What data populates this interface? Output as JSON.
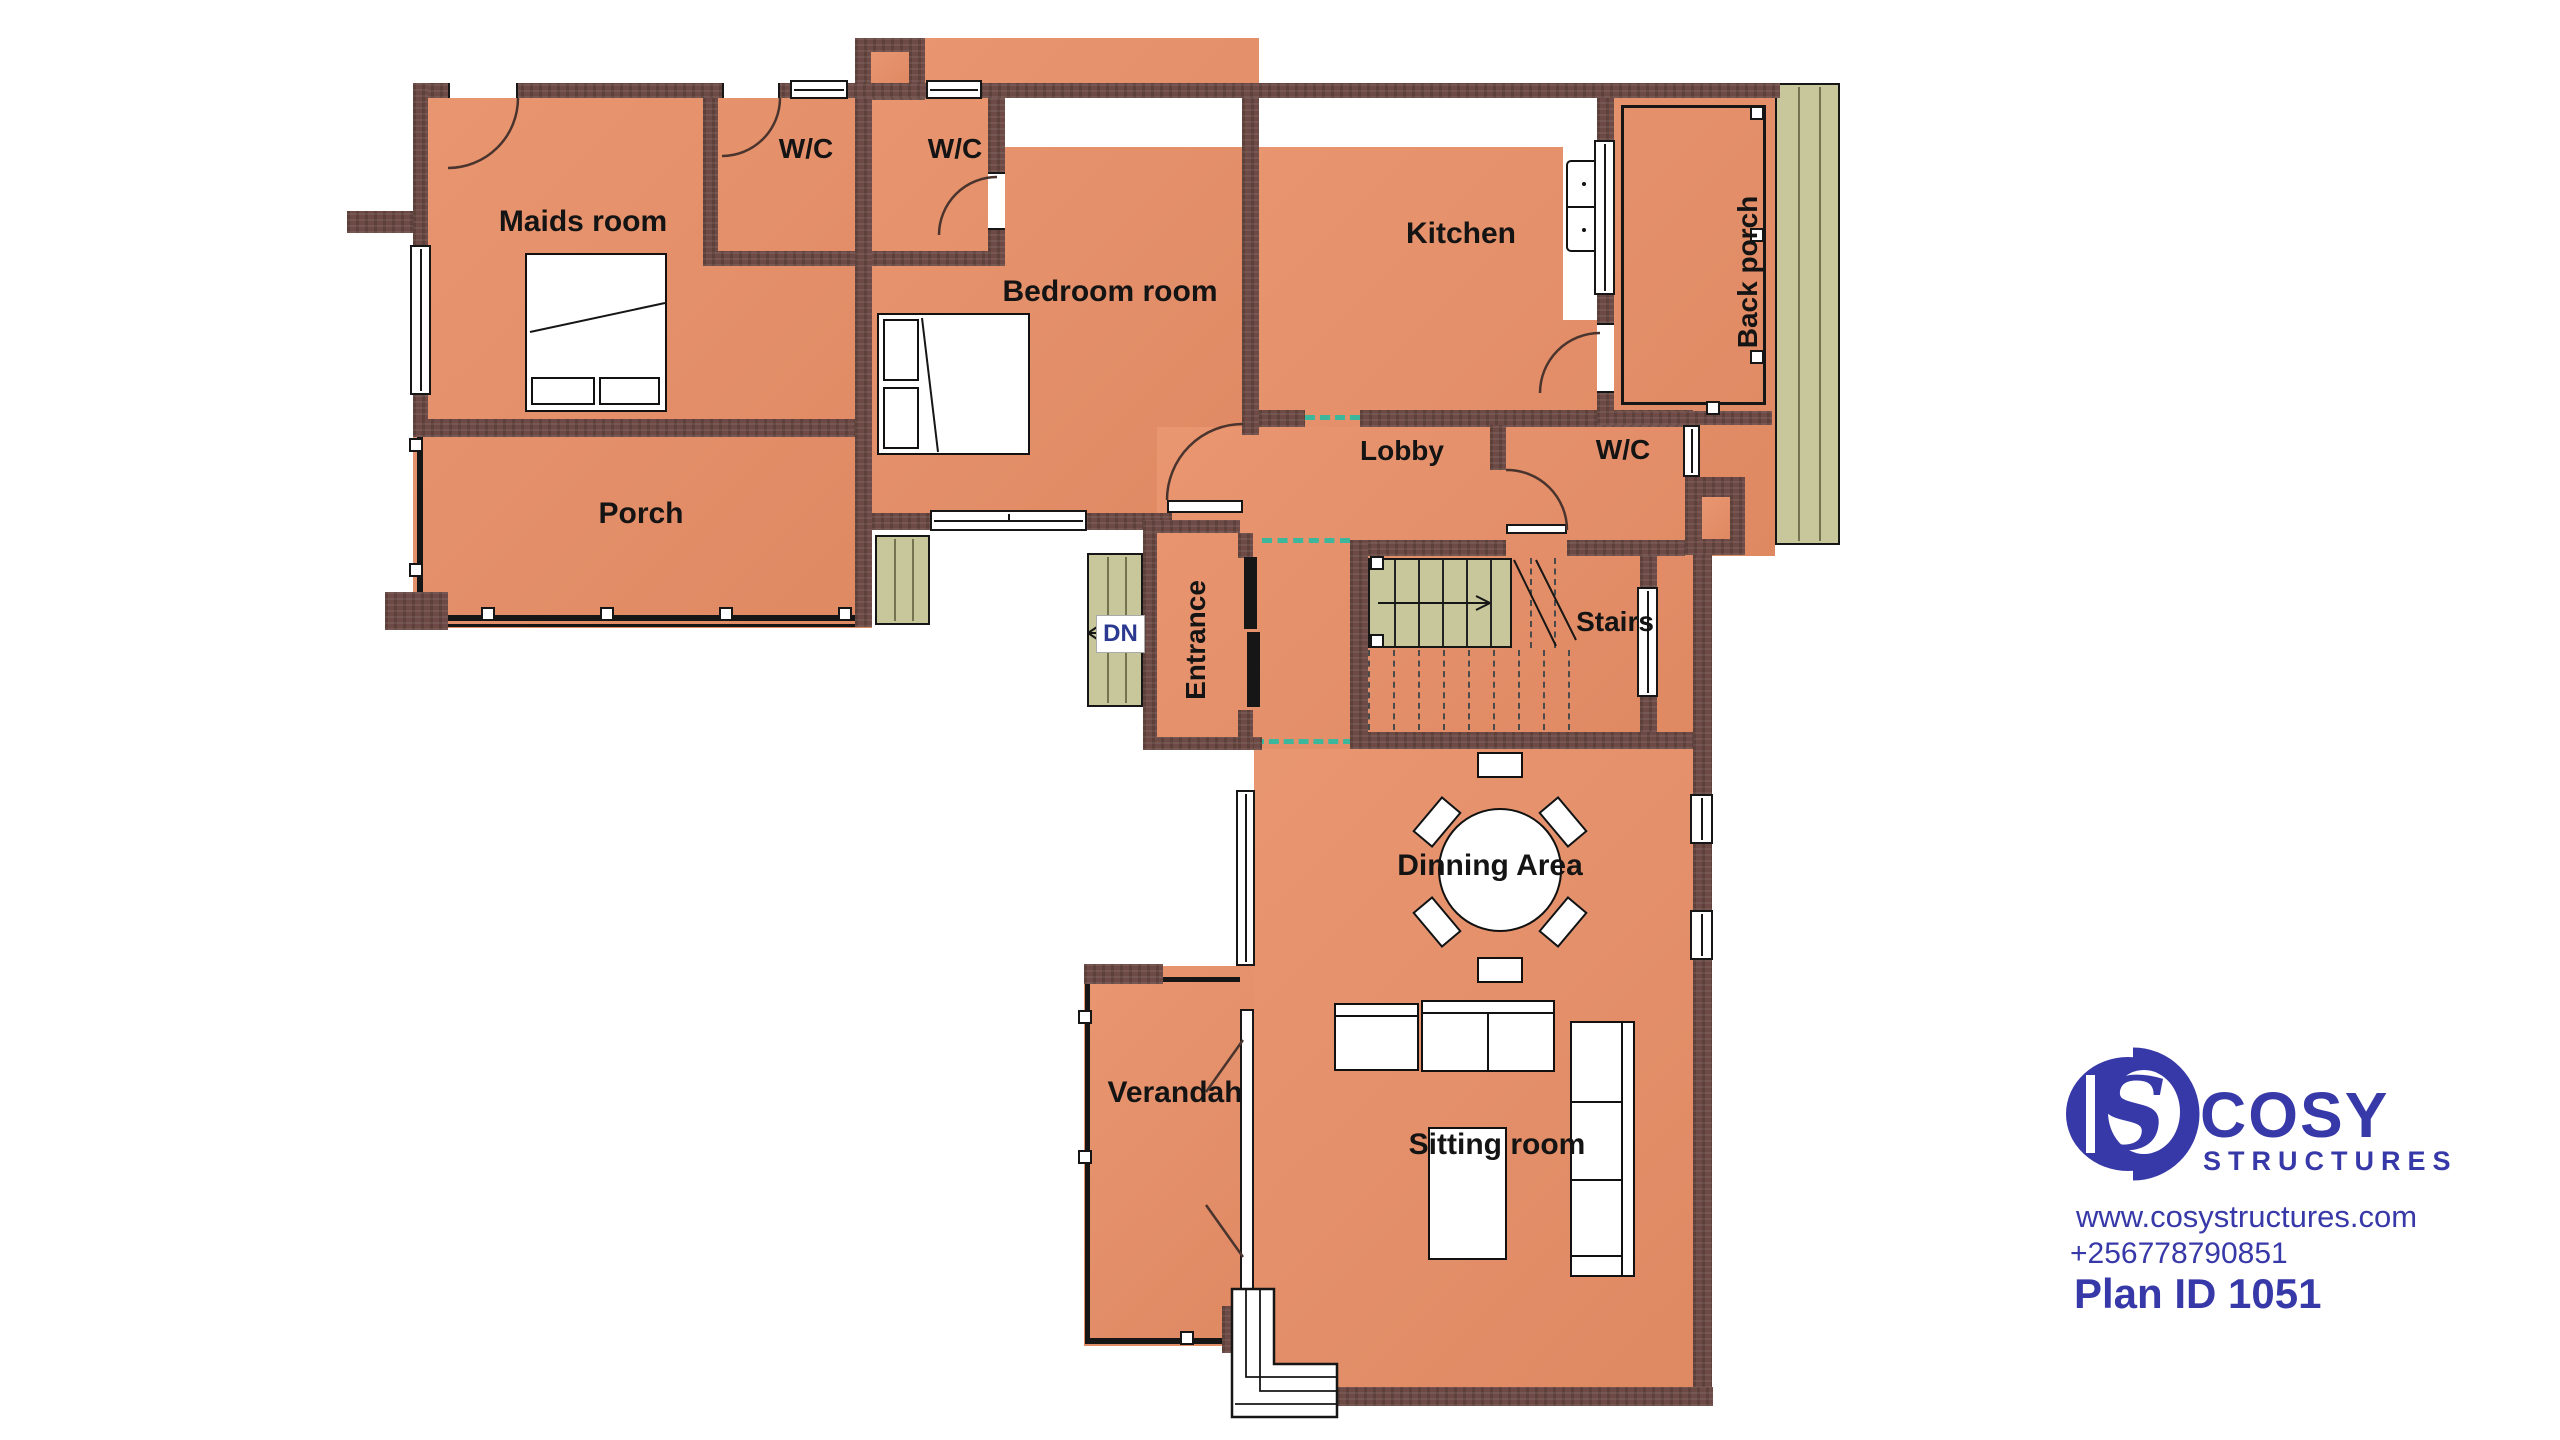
{
  "rooms": {
    "maids": {
      "label": "Maids room"
    },
    "wc1": {
      "label": "W/C"
    },
    "wc2": {
      "label": "W/C"
    },
    "wc3": {
      "label": "W/C"
    },
    "bedroom": {
      "label": "Bedroom room"
    },
    "kitchen": {
      "label": "Kitchen"
    },
    "back_porch": {
      "label": "Back porch"
    },
    "porch": {
      "label": "Porch"
    },
    "lobby": {
      "label": "Lobby"
    },
    "entrance": {
      "label": "Entrance"
    },
    "stairs": {
      "label": "Stairs"
    },
    "dining": {
      "label": "Dinning Area"
    },
    "verandah": {
      "label": "Verandah"
    },
    "sitting": {
      "label": "Sitting room"
    }
  },
  "annotations": {
    "down_label": "DN"
  },
  "brand": {
    "name": "COSY",
    "sub": "STRUCTURES",
    "website": "www.cosystructures.com",
    "phone": "+256778790851",
    "plan_id": "Plan ID 1051",
    "logo_monogram": "S"
  },
  "colors": {
    "wall": "#6d4a45",
    "floor": "#e78e66",
    "steps_green": "#c8c79b",
    "dash_teal": "#3db79c",
    "logo_blue": "#3839a8",
    "outline": "#161616"
  }
}
